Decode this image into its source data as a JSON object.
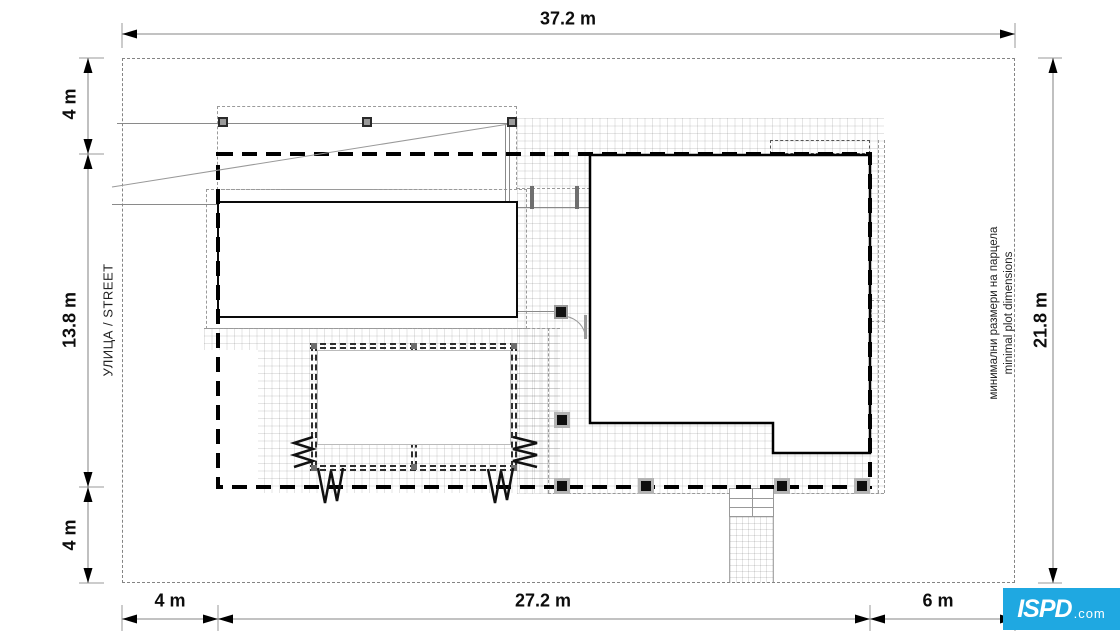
{
  "dims": {
    "top": "37.2 m",
    "left_top": "4 m",
    "left_mid": "13.8 m",
    "left_bot": "4 m",
    "bottom_left": "4 m",
    "bottom_mid": "27.2 m",
    "bottom_right": "6 m",
    "right": "21.8 m"
  },
  "labels": {
    "street": "УЛИЦА / STREET",
    "note_bg": "минимални размери на парцела",
    "note_en": "minimal plot dimensions"
  },
  "logo": {
    "mark": "ISPD",
    "suffix": ".com"
  },
  "colors": {
    "logo_bg": "#1fa8e1",
    "envelope_line": "#000000",
    "dim_line": "#9e9e9e",
    "grid_line": "#e4e4e4"
  }
}
